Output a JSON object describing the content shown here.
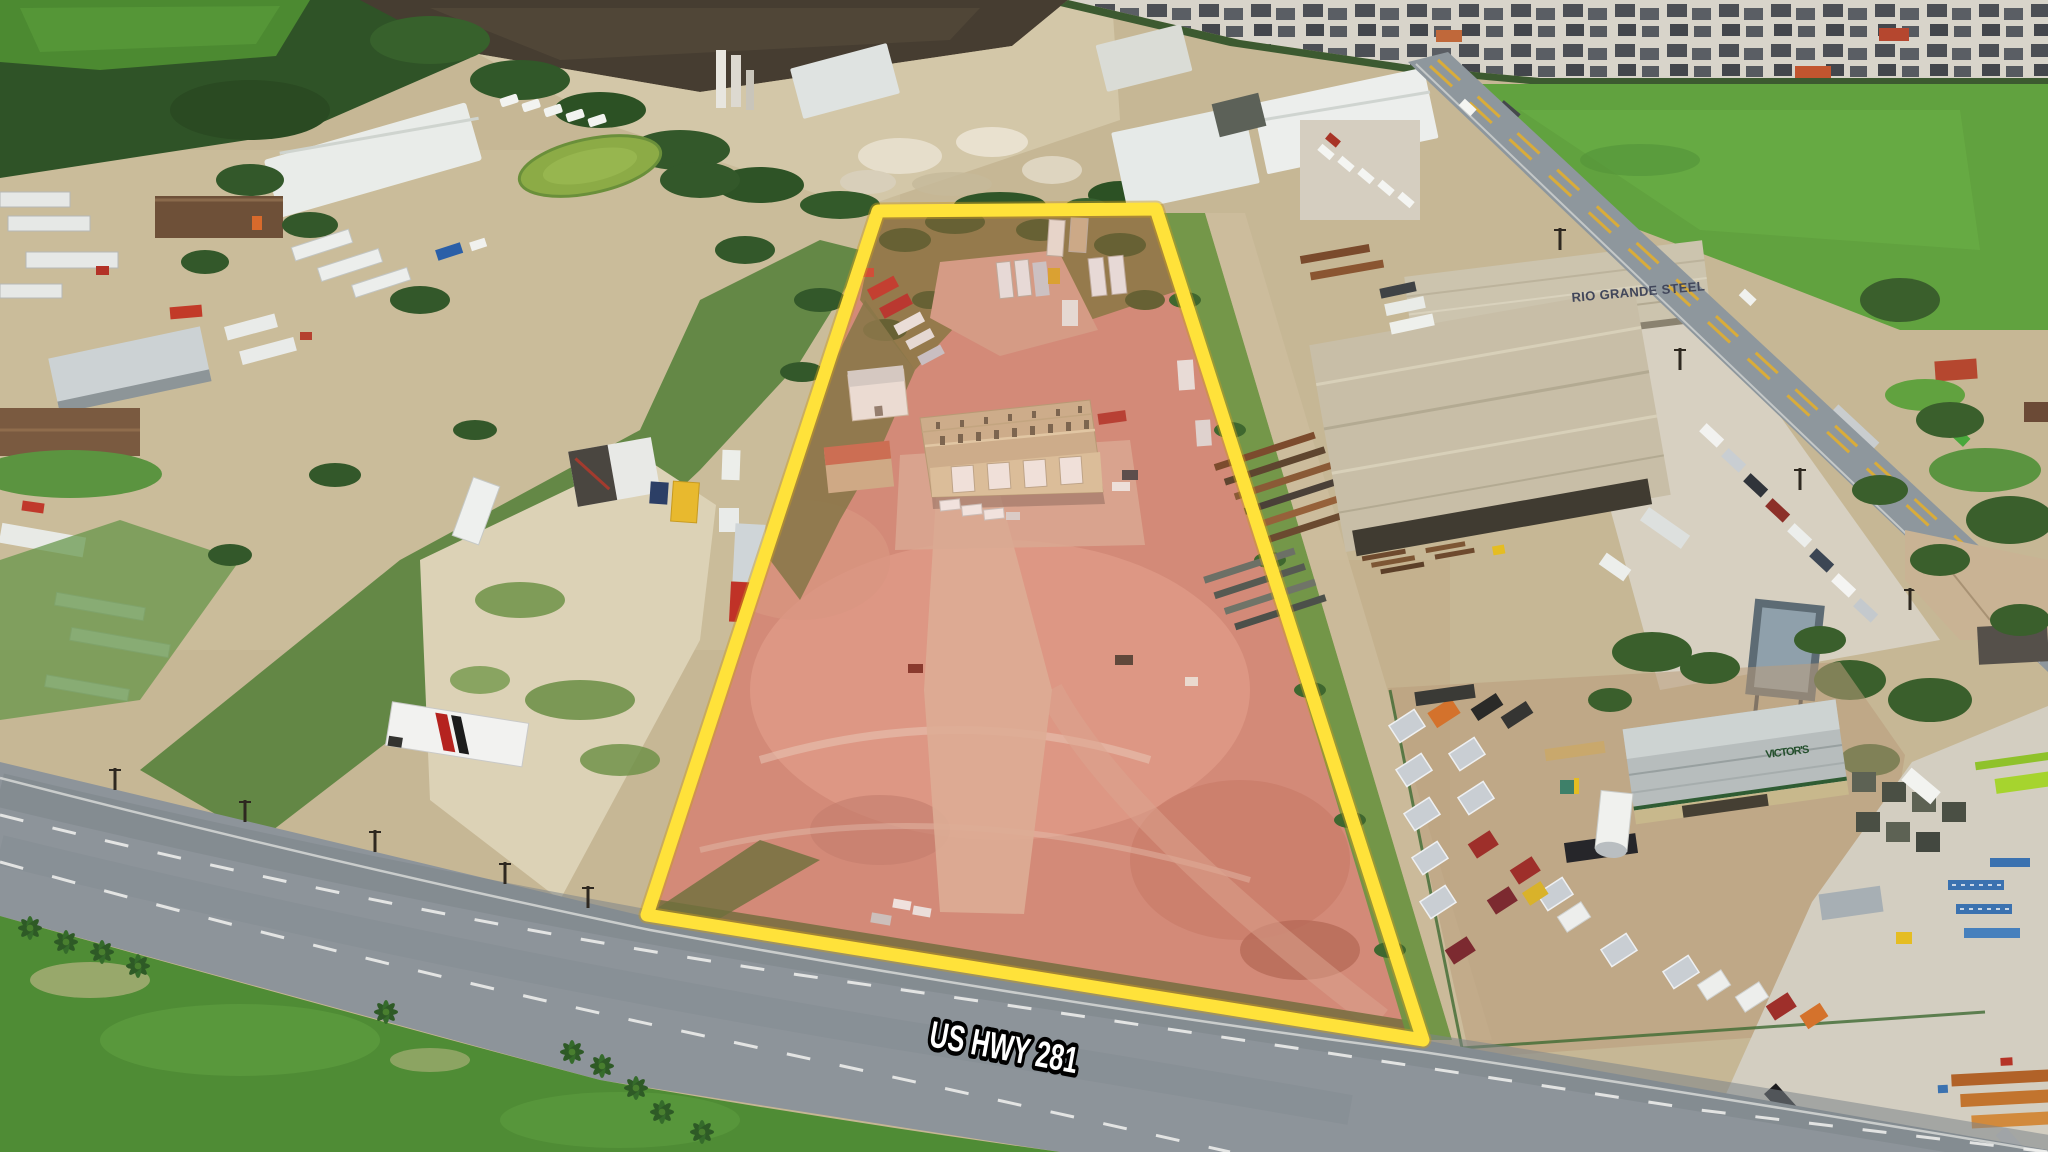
{
  "scene": {
    "description": "Aerial drone photo of an industrial parcel outlined in yellow beside US HWY 281, flanked by a steel warehouse complex, trailer dealership, truck yards, farm fields and a residential subdivision",
    "road_label": "US HWY 281",
    "steel_building_sign": "RIO GRANDE STEEL",
    "trailer_store_sign": "VICTOR'S",
    "colors": {
      "boundary_yellow": "#FFE23A",
      "boundary_shadow": "#C89C20",
      "parcel_tint": "#E06A5A",
      "parcel_dirt_pink": "#D18F7D",
      "highway_gray": "#8D949A",
      "grass_green": "#4F8C35",
      "field_green": "#61A23F",
      "tree_green": "#33582A",
      "dirt_tan": "#C6B795",
      "caliche_white": "#DDD3B8",
      "plowed_brown": "#463D31",
      "metal_building_tan": "#CBB691",
      "warehouse_white": "#E9ECE9",
      "steel_building_tan": "#C8BEA7",
      "pond_green": "#8CAB46",
      "label_fill": "#FFFFFF",
      "label_stroke": "#000000"
    }
  }
}
